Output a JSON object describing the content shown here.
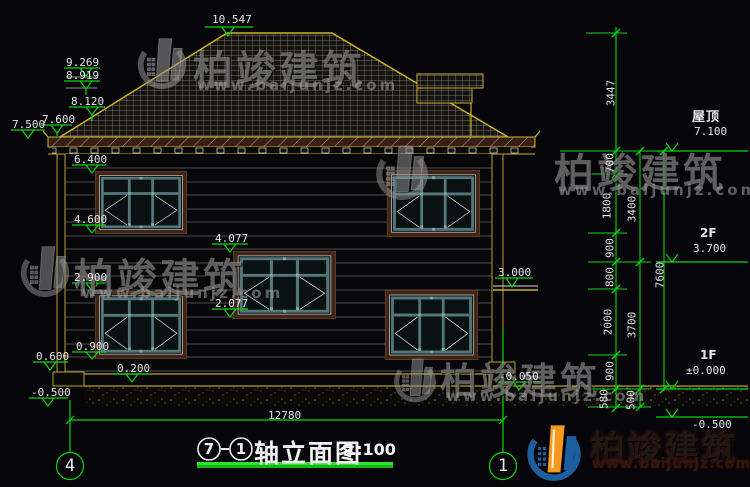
{
  "drawing": {
    "title": {
      "axis_from": "7",
      "axis_sep": "-",
      "axis_to": "1",
      "name": "轴立面图",
      "scale": "1:100"
    },
    "axes": {
      "left": "4",
      "right": "1"
    },
    "total_width_dim": "12780"
  },
  "labels": {
    "ridge": "10.547",
    "r9269": "9.269",
    "r8919": "8.919",
    "r8120": "8.120",
    "r7600": "7.600",
    "r7500": "7.500",
    "w6400": "6.400",
    "w4600": "4.600",
    "s4077": "4.077",
    "w2900": "2.900",
    "s2077": "2.077",
    "w0900": "0.900",
    "p0600": "0.600",
    "f0200": "0.200",
    "gneg500": "-0.500",
    "canopy3000": "3.000",
    "porchneg050": "-0.050",
    "total": "12780",
    "roof_cn": "屋顶",
    "roof_lv": "7.100",
    "f2": "2F",
    "f2_lv": "3.700",
    "f1": "1F",
    "f1_lv": "±0.000",
    "base_lv": "-0.500",
    "c3447": "3447",
    "c700": "700",
    "c1800": "1800",
    "c3400": "3400",
    "c900a": "900",
    "c800": "800",
    "c2000": "2000",
    "c3700": "3700",
    "c7600": "7600",
    "c900b": "900",
    "c580": "580",
    "c500": "500"
  },
  "watermark": {
    "cjk": "柏竣建筑",
    "url": "www.baijunjz.com"
  },
  "logo": {
    "cjk": "柏竣建筑",
    "url": "www.baijunjz.com"
  },
  "colors": {
    "dim_green": "#0cd60c",
    "cad_yellow": "#c9b32e",
    "text_white": "#e6e6e6",
    "frame_brown": "#3f2518",
    "sash_teal": "#54777a",
    "logo_blue": "#1d5e9e",
    "logo_orange": "#f59a1d"
  }
}
